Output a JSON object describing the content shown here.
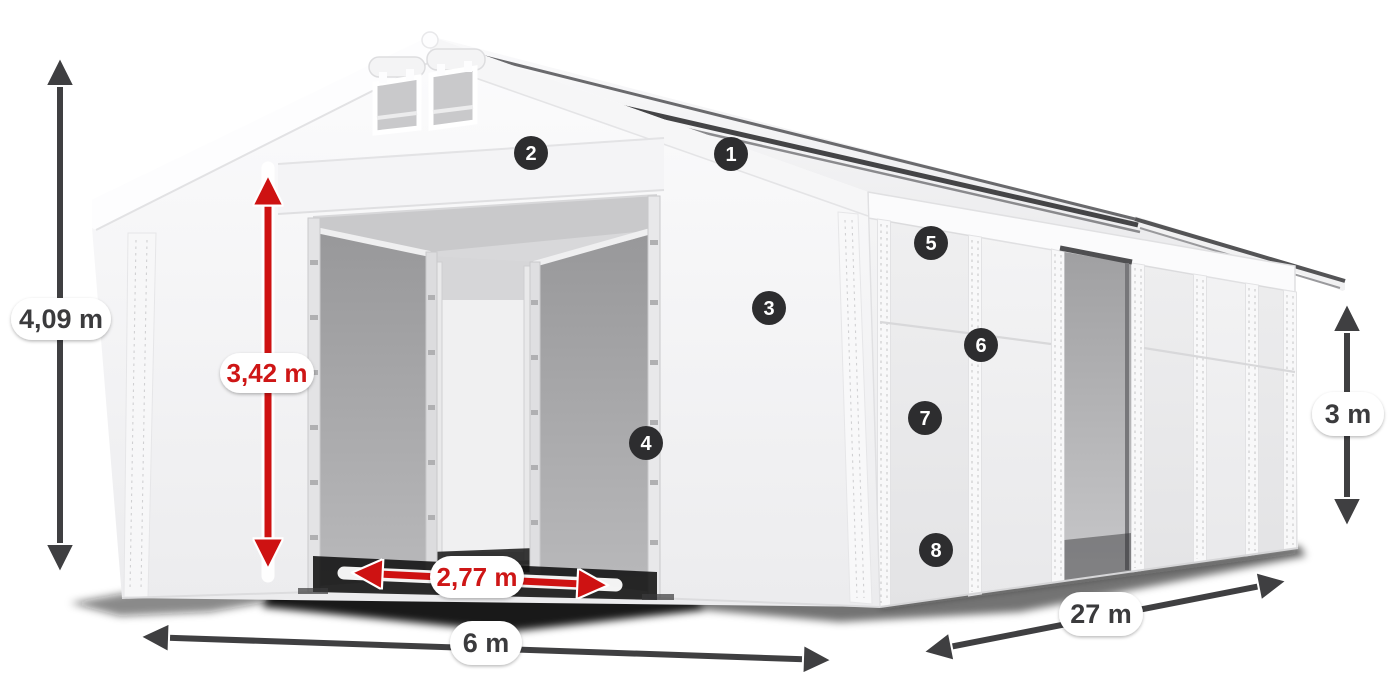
{
  "diagram": {
    "background": "#ffffff",
    "dimension_labels": {
      "total_height": "4,09 m",
      "clear_entrance_height": "3,42 m",
      "clear_entrance_width": "2,77 m",
      "tent_width": "6 m",
      "tent_length": "27 m",
      "side_wall_height": "3 m"
    },
    "feature_markers": [
      {
        "number": "1"
      },
      {
        "number": "2"
      },
      {
        "number": "3"
      },
      {
        "number": "4"
      },
      {
        "number": "5"
      },
      {
        "number": "6"
      },
      {
        "number": "7"
      },
      {
        "number": "8"
      }
    ],
    "colors": {
      "red_dimension": "#ce1212",
      "dark_dimension": "#3f3f41",
      "badge_background": "#2d2d2f",
      "badge_number": "#ffffff",
      "label_pill_background": "#ffffff",
      "label_text_dark": "#3a3a3c",
      "tent_fabric": "#f2f2f3",
      "interior_fabric": "#a9a9ab",
      "ground_shadow": "#111111"
    }
  }
}
